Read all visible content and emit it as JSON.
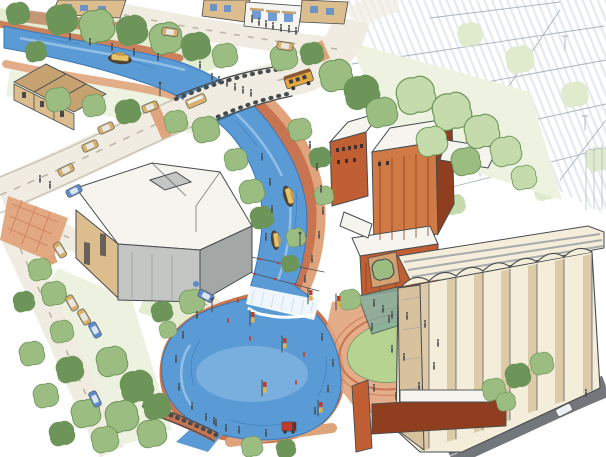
{
  "scene": {
    "type": "watercolor-architectural-rendering",
    "view": "aerial-perspective",
    "objects": {
      "river": "winding river canal",
      "pond": "kidney-shaped plunge pool",
      "waterfall": "whitewater weir",
      "stream_outlet": "pool outlet stream",
      "road_bridge": "street bridge over river",
      "pedestrian_bridge": "pedestrian bridge at pool outlet",
      "riverwalk": "terracotta riverwalk promenade",
      "amphitheater": "oval event lawn with brick ring",
      "mill": "red-brick mill buildings",
      "silos": "cream grain-silo cluster",
      "cultural_building": "modern flat-roof gray building",
      "townhouses": "tan gabled rowhouses",
      "cafe": "sidewalk cafe storefront",
      "parking_sketch": "lightly sketched parking lots",
      "trolley": "orange trolley bus",
      "boats": "canopied tour boats",
      "pedestrians": "small walking figures",
      "banner_poles": "lamp posts with red and yellow banners"
    }
  },
  "palette": {
    "paper": "#ffffff",
    "street": "#f0ece1",
    "street_line": "#b9b3a3",
    "asphalt": "#73767a",
    "walk": "#c97450",
    "walk_light": "#e0a47c",
    "walk_dark": "#a5552f",
    "river": "#5b9bd5",
    "river_light": "#9cc6e9",
    "river_deep": "#3a77b5",
    "waterfall": "#f0f7fc",
    "lawn": "#b7d391",
    "grass_wash": "#e4edd2",
    "foliage_wash": "#edf3e0",
    "tree_dark": "#6d9459",
    "tree_mid": "#9cbd82",
    "tree_light": "#c6dbab",
    "tree_faint": "#e0ebce",
    "brick": "#c05f33",
    "brick_light": "#d07a45",
    "brick_dark": "#8f3f20",
    "tan": "#dcbd8d",
    "tan_dark": "#c7a271",
    "roof_white": "#f5f4ee",
    "gray_wall": "#c3c6c3",
    "gray_wall_dark": "#a3a7a5",
    "silo_cream": "#f4edda",
    "silo_shade": "#d7c29d",
    "silo_gray": "#9fa3a6",
    "ink": "#464b4e",
    "ink_light": "#a8b2ba",
    "sketch": "#d9e1e7",
    "banner_red": "#c43b2e",
    "banner_yellow": "#e8b33c",
    "car_tan": "#d9b06a",
    "car_blue": "#5c8ccd",
    "car_white": "#f2f4f6",
    "boat_hull": "#4c4238",
    "boat_canopy": "#e4c36a",
    "teal": "#7fae9e"
  }
}
